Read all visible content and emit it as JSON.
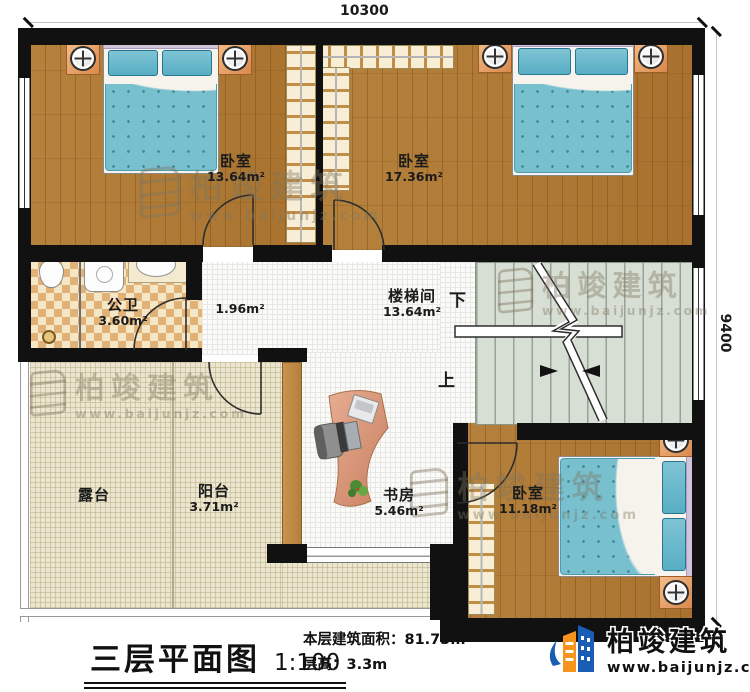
{
  "dimensions": {
    "width_label": "10300",
    "height_label": "9400"
  },
  "rooms": {
    "bedroom_top_left": {
      "name": "卧室",
      "area": "13.64m²"
    },
    "bedroom_top_right": {
      "name": "卧室",
      "area": "17.36m²"
    },
    "bedroom_bottom_right": {
      "name": "卧室",
      "area": "11.18m²"
    },
    "bathroom": {
      "name": "公卫",
      "area": "3.60m²"
    },
    "hallway": {
      "area": "1.96m²"
    },
    "stairwell": {
      "name": "楼梯间",
      "area": "13.64m²",
      "down_label": "下",
      "up_label": "上"
    },
    "terrace": {
      "name": "露台"
    },
    "balcony": {
      "name": "阳台",
      "area": "3.71m²"
    },
    "study": {
      "name": "书房",
      "area": "5.46m²"
    }
  },
  "title_block": {
    "title": "三层平面图",
    "scale": "1:100",
    "area_line": "本层建筑面积：81.73m²",
    "height_line": "层高：3.3m"
  },
  "brand": {
    "name": "柏竣建筑",
    "website": "www.baijunjz.com"
  },
  "watermark": {
    "name": "柏竣建筑",
    "website": "www.baijunjz.com"
  },
  "colors": {
    "wall": "#111111",
    "wood_floor": "#b07c36",
    "bedding": "#74bdcd",
    "outdoor_floor": "#ece6cf",
    "stair_floor": "#d7ded3",
    "brand_blue": "#1a5db5",
    "brand_orange": "#f7941d"
  }
}
